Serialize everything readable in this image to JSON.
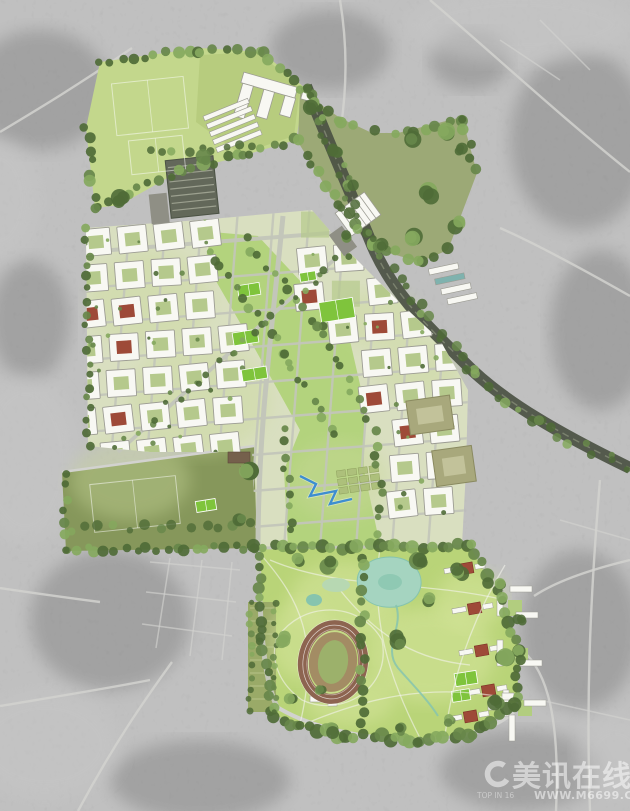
{
  "meta": {
    "title": "Aerial photograph with colored urban masterplan overlay",
    "view_type": "top-down satellite / masterplan rendering"
  },
  "watermark": {
    "logo_text": "美讯在线",
    "url": "WWW.M6699.COM",
    "small_text": "TOP IN 16"
  },
  "map_features": [
    "sports-pitches",
    "school-campus",
    "glasshouses",
    "retained-shed",
    "residential-perimeter-blocks",
    "central-green-spine",
    "tree-lined-boulevard",
    "railway-corridor",
    "warehouse",
    "allotments",
    "water-channel",
    "lake",
    "marsh",
    "pond",
    "stream",
    "athletics-stadium",
    "parkland",
    "villa-row",
    "terrace-blocks",
    "playing-fields",
    "tennis-courts"
  ],
  "colors": {
    "bg": "#9d9d9d",
    "bg_dark": "#7e7e7e",
    "bg_light": "#c6c6c6",
    "bg_road": "#d2d2cf",
    "plan_pale": "#d9dfc0",
    "plan_tint": "#c9d89a",
    "park_green": "#b9d478",
    "park_light": "#d6e59c",
    "spine_green": "#aed276",
    "pitch_green": "#c3d78c",
    "pitch_green2": "#b7cc7e",
    "olive_field": "#9aa873",
    "left_field": "#86975b",
    "allotment": "#9aaa68",
    "tree_dark": "#4f6b37",
    "tree_mid": "#67874a",
    "tree_light": "#85a95e",
    "court_green": "#7fc43c",
    "building_white": "#f8f8f3",
    "building_stroke": "#9c9c93",
    "courtyard_green": "#b5c98c",
    "roof_red": "#9e4a38",
    "roof_red_dark": "#7c3226",
    "olive_building": "#a8a87c",
    "olive_building_line": "#8a8a60",
    "teal_building": "#7fb2ae",
    "shed_dark": "#63685a",
    "shed_stripe": "#9ca08f",
    "barn_brown": "#75604c",
    "gray_apron": "#8f8f85",
    "rail_dark": "#4b5244",
    "rail_line": "#7f8672",
    "plan_road": "#c3c6ba",
    "water": "#a5d4c0",
    "water_deep": "#86c4ae",
    "water_blue": "#3e8ed0",
    "track_brown": "#8d6450",
    "infield_tan": "#a38c64",
    "infield_green": "#9cb16b",
    "path_white": "#f4f4ec",
    "watermark_white": "#ffffff"
  }
}
